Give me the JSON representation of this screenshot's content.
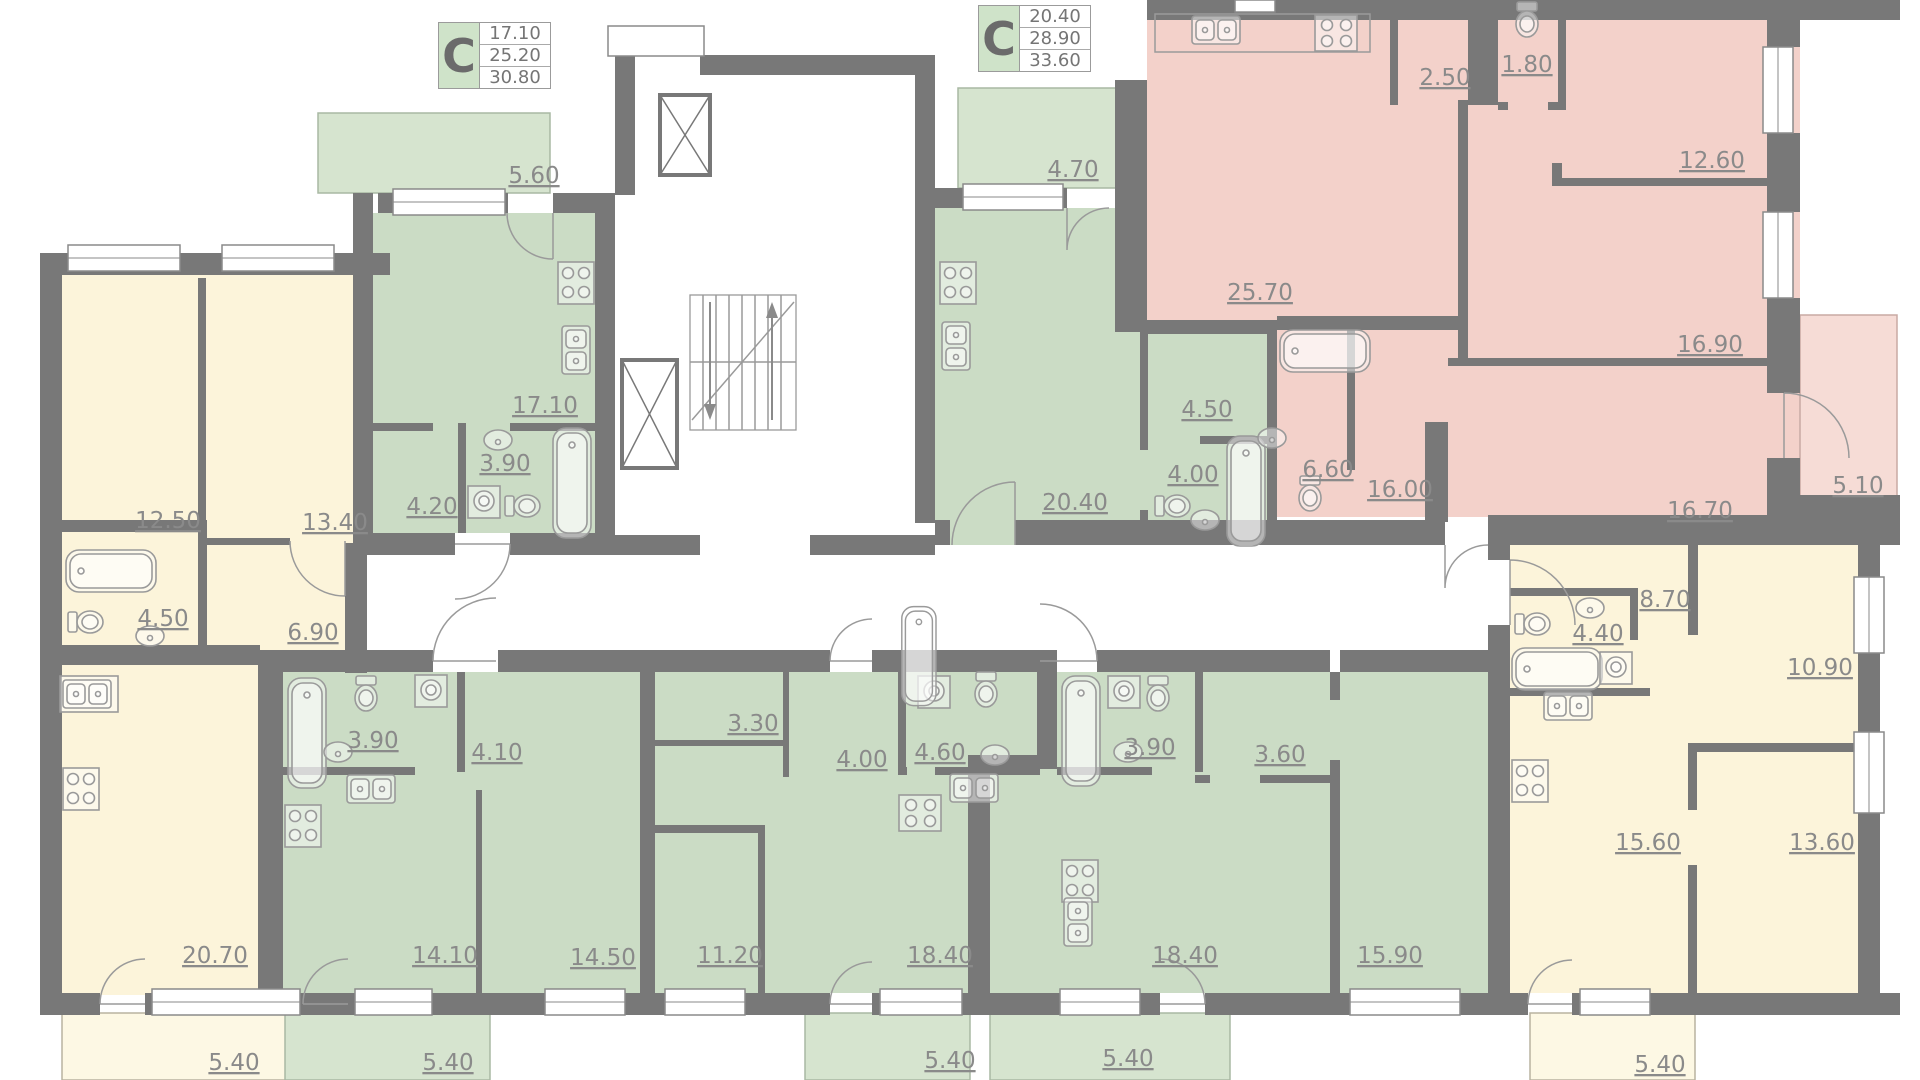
{
  "page": {
    "title": "Residential floor plan"
  },
  "colors": {
    "wall": "#787878",
    "green_room": "#cbdcc5",
    "green_balcony": "#d6e4cf",
    "yellow_room": "#fcf4da",
    "yellow_balcony": "#fdf8e4",
    "pink_room": "#f3d1ca",
    "pink_balcony": "#f6dcd6",
    "label_text": "#8a8a8a",
    "legend_cell": "#cfe3c9"
  },
  "legend": {
    "left": {
      "type_label": "C",
      "areas": [
        "17.10",
        "25.20",
        "30.80"
      ]
    },
    "right": {
      "type_label": "C",
      "areas": [
        "20.40",
        "28.90",
        "33.60"
      ]
    }
  },
  "apartments": [
    {
      "id": "apartment-left-yellow",
      "palette": "yellow",
      "rooms": [
        {
          "type": "bedroom",
          "area": "12.50"
        },
        {
          "type": "bedroom",
          "area": "13.40"
        },
        {
          "type": "bathroom",
          "area": "4.50"
        },
        {
          "type": "hallway",
          "area": "6.90"
        },
        {
          "type": "kitchen-living",
          "area": "20.70"
        },
        {
          "type": "balcony",
          "area": "5.40"
        }
      ]
    },
    {
      "id": "apartment-studio-green-top-left",
      "palette": "green",
      "rooms": [
        {
          "type": "balcony",
          "area": "5.60"
        },
        {
          "type": "kitchen-living",
          "area": "17.10"
        },
        {
          "type": "bathroom",
          "area": "3.90"
        },
        {
          "type": "hallway",
          "area": "4.20"
        }
      ]
    },
    {
      "id": "apartment-studio-green-top-middle",
      "palette": "green",
      "rooms": [
        {
          "type": "balcony",
          "area": "4.70"
        },
        {
          "type": "kitchen-living",
          "area": "20.40"
        },
        {
          "type": "hallway",
          "area": "4.50"
        },
        {
          "type": "bathroom",
          "area": "4.00"
        }
      ]
    },
    {
      "id": "apartment-pink-right-top",
      "palette": "pink",
      "rooms": [
        {
          "type": "kitchen-living",
          "area": "25.70"
        },
        {
          "type": "storage",
          "area": "2.50"
        },
        {
          "type": "wc",
          "area": "1.80"
        },
        {
          "type": "bedroom",
          "area": "12.60"
        },
        {
          "type": "bedroom",
          "area": "16.90"
        },
        {
          "type": "bathroom",
          "area": "6.60"
        },
        {
          "type": "hallway",
          "area": "16.00"
        },
        {
          "type": "bedroom",
          "area": "16.70"
        },
        {
          "type": "balcony",
          "area": "5.10"
        }
      ]
    },
    {
      "id": "apartment-green-bottom-left",
      "palette": "green",
      "rooms": [
        {
          "type": "bathroom",
          "area": "3.90"
        },
        {
          "type": "hallway",
          "area": "4.10"
        },
        {
          "type": "kitchen-living",
          "area": "14.10"
        },
        {
          "type": "bedroom",
          "area": "14.50"
        },
        {
          "type": "balcony",
          "area": "5.40"
        }
      ]
    },
    {
      "id": "apartment-green-bottom-middle",
      "palette": "green",
      "rooms": [
        {
          "type": "storage",
          "area": "3.30"
        },
        {
          "type": "hallway",
          "area": "4.00"
        },
        {
          "type": "bathroom",
          "area": "4.60"
        },
        {
          "type": "bedroom",
          "area": "11.20"
        },
        {
          "type": "kitchen-living",
          "area": "18.40"
        },
        {
          "type": "balcony",
          "area": "5.40"
        }
      ]
    },
    {
      "id": "apartment-green-bottom-right",
      "palette": "green",
      "rooms": [
        {
          "type": "bathroom",
          "area": "3.90"
        },
        {
          "type": "hallway",
          "area": "3.60"
        },
        {
          "type": "kitchen-living",
          "area": "18.40"
        },
        {
          "type": "bedroom",
          "area": "15.90"
        },
        {
          "type": "balcony",
          "area": "5.40"
        }
      ]
    },
    {
      "id": "apartment-right-yellow",
      "palette": "yellow",
      "rooms": [
        {
          "type": "hallway",
          "area": "8.70"
        },
        {
          "type": "bathroom",
          "area": "4.40"
        },
        {
          "type": "bedroom",
          "area": "10.90"
        },
        {
          "type": "kitchen-living",
          "area": "15.60"
        },
        {
          "type": "bedroom",
          "area": "13.60"
        },
        {
          "type": "balcony",
          "area": "5.40"
        }
      ]
    }
  ]
}
